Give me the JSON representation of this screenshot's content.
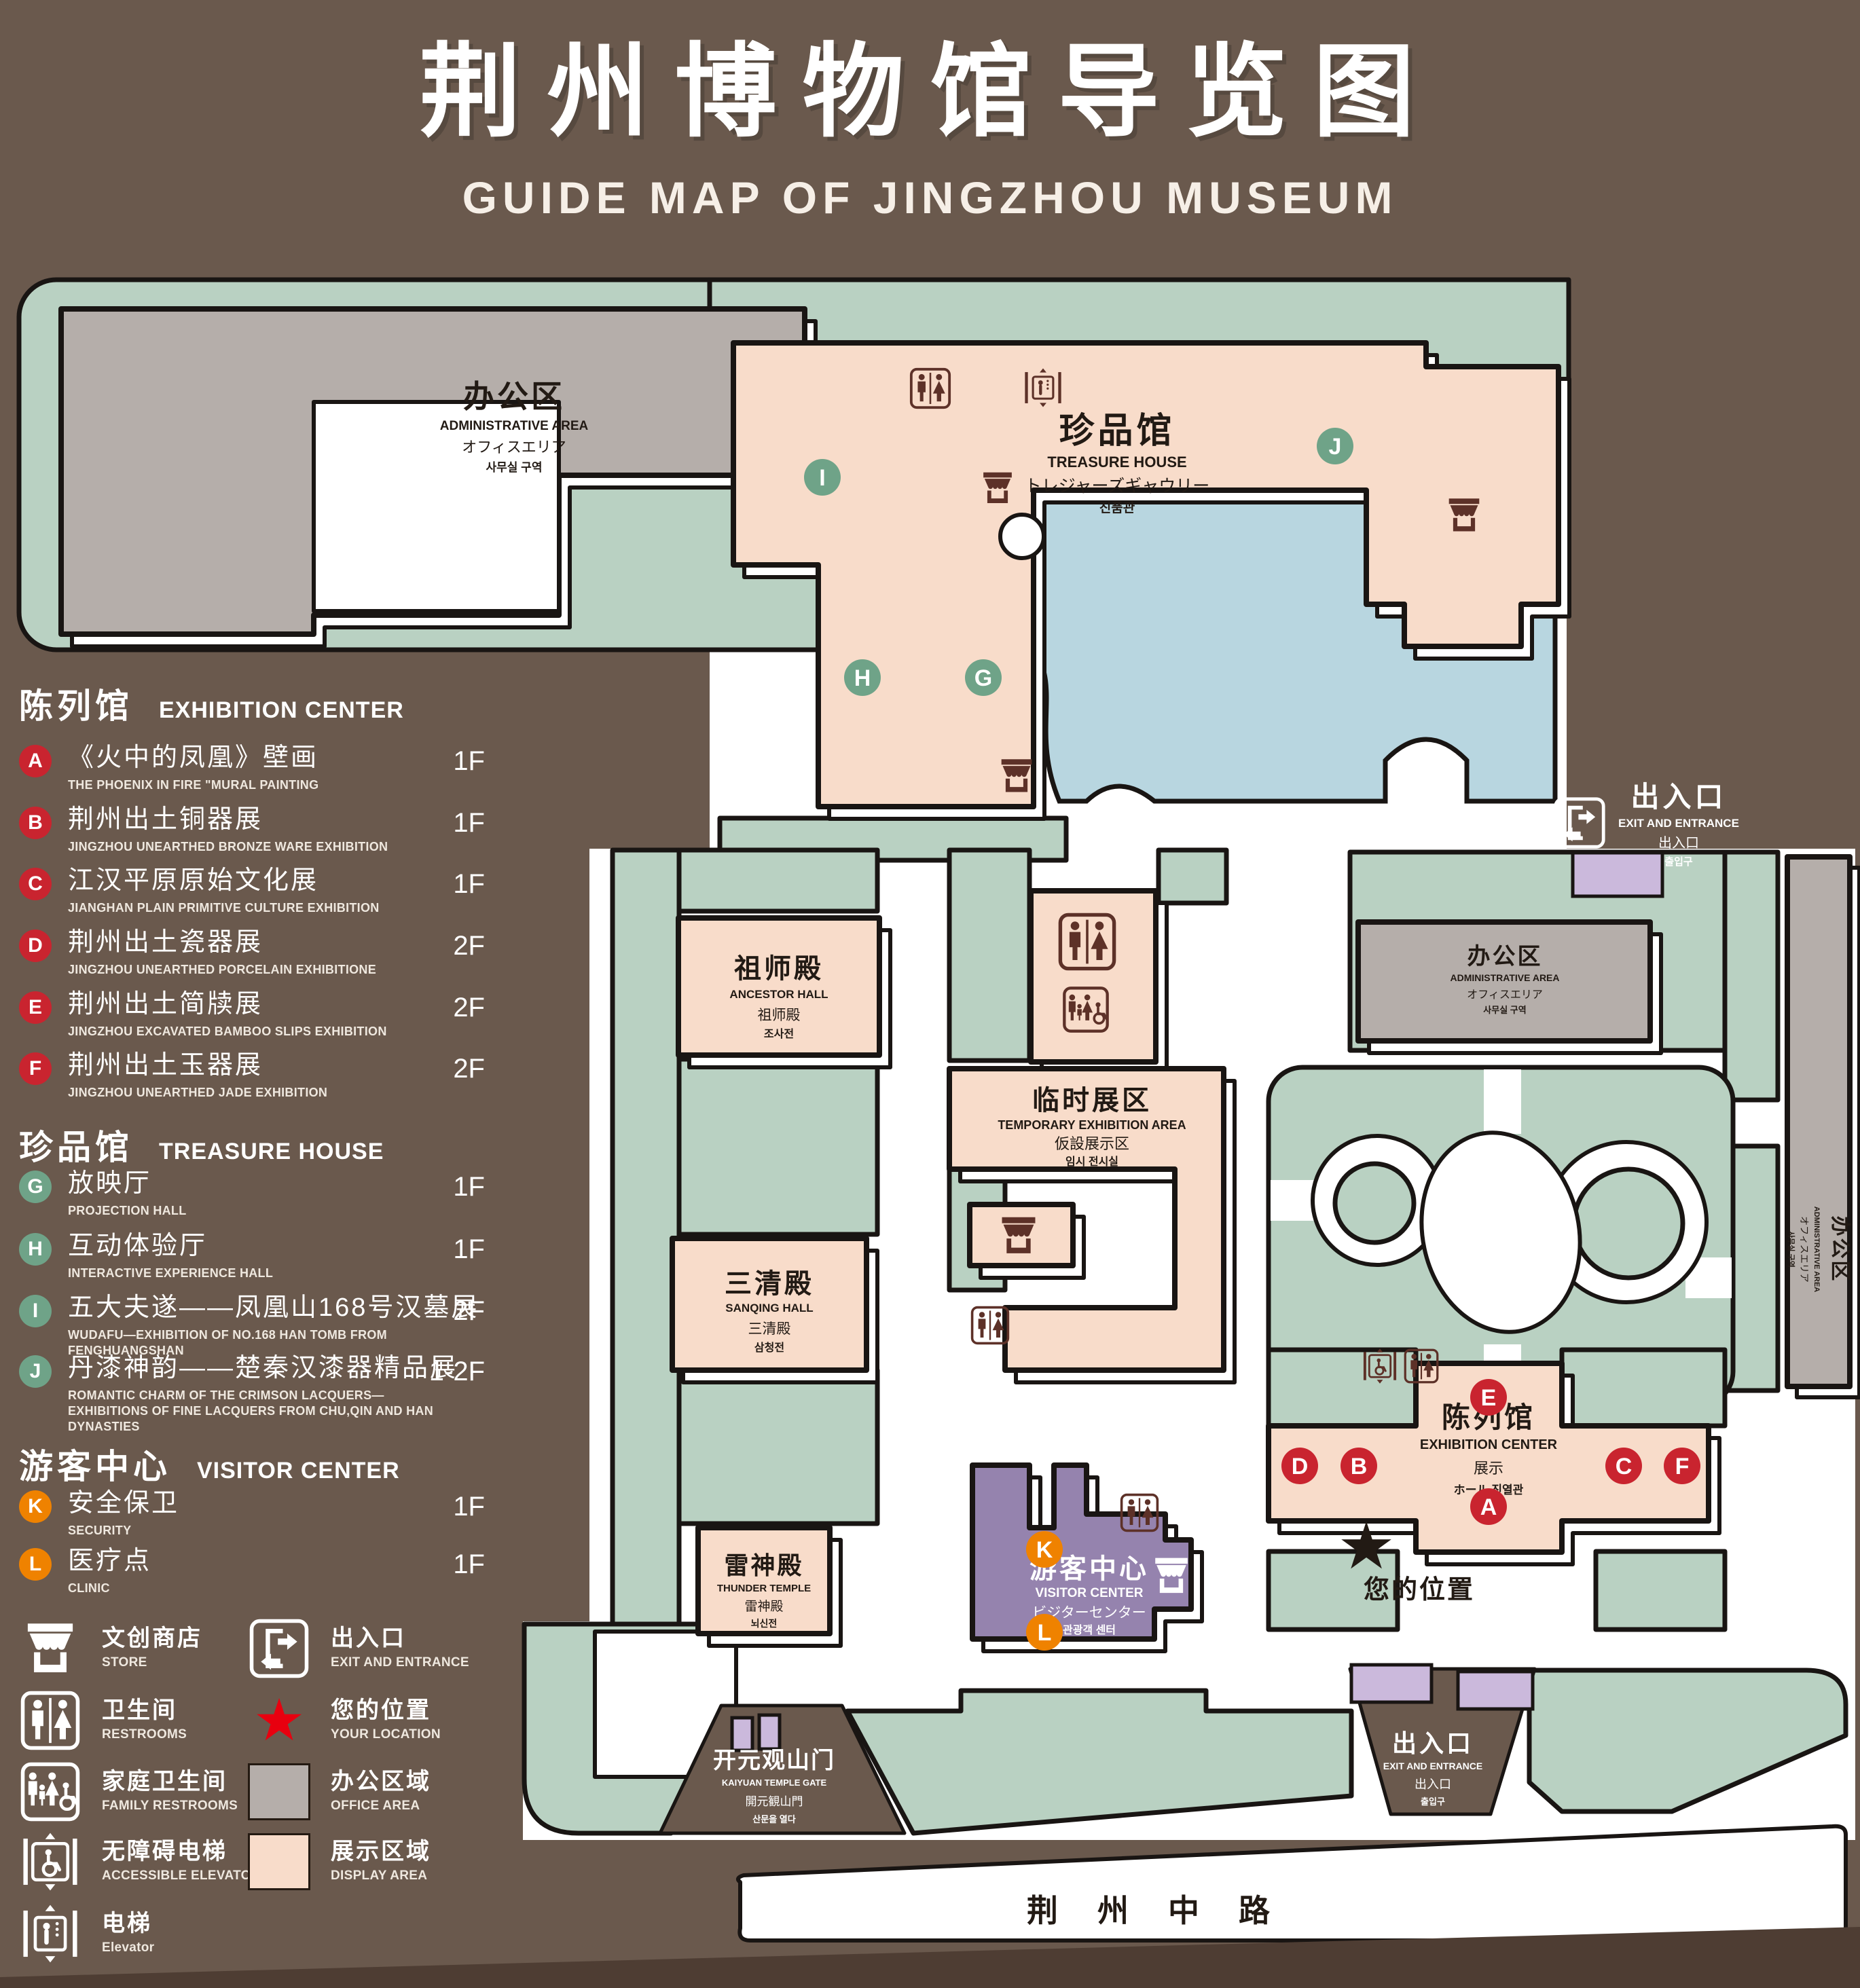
{
  "title": {
    "zh": "荆州博物馆导览图",
    "en": "GUIDE MAP OF JINGZHOU MUSEUM"
  },
  "legend": {
    "sections": [
      {
        "zh": "陈列馆",
        "en": "EXHIBITION CENTER",
        "items": [
          {
            "letter": "A",
            "zh": "《火中的凤凰》壁画",
            "en": "THE PHOENIX IN FIRE \"MURAL PAINTING",
            "floor": "1F"
          },
          {
            "letter": "B",
            "zh": "荆州出土铜器展",
            "en": "JINGZHOU UNEARTHED BRONZE WARE EXHIBITION",
            "floor": "1F"
          },
          {
            "letter": "C",
            "zh": "江汉平原原始文化展",
            "en": "JIANGHAN PLAIN PRIMITIVE CULTURE EXHIBITION",
            "floor": "1F"
          },
          {
            "letter": "D",
            "zh": "荆州出土瓷器展",
            "en": "JINGZHOU UNEARTHED PORCELAIN EXHIBITIONE",
            "floor": "2F"
          },
          {
            "letter": "E",
            "zh": "荆州出土简牍展",
            "en": "JINGZHOU EXCAVATED BAMBOO SLIPS EXHIBITION",
            "floor": "2F"
          },
          {
            "letter": "F",
            "zh": "荆州出土玉器展",
            "en": "JINGZHOU UNEARTHED JADE EXHIBITION",
            "floor": "2F"
          }
        ]
      },
      {
        "zh": "珍品馆",
        "en": "TREASURE HOUSE",
        "items": [
          {
            "letter": "G",
            "zh": "放映厅",
            "en": "PROJECTION HALL",
            "floor": "1F"
          },
          {
            "letter": "H",
            "zh": "互动体验厅",
            "en": "INTERACTIVE EXPERIENCE HALL",
            "floor": "1F"
          },
          {
            "letter": "I",
            "zh": "五大夫遂——凤凰山168号汉墓展",
            "en": "WUDAFU—EXHIBITION OF NO.168 HAN TOMB FROM FENGHUANGSHAN",
            "floor": "2F"
          },
          {
            "letter": "J",
            "zh": "丹漆神韵——楚秦汉漆器精品展",
            "en": "ROMANTIC CHARM OF THE CRIMSON LACQUERS—EXHIBITIONS OF FINE LACQUERS FROM CHU,QIN AND HAN DYNASTIES",
            "floor": "1-2F"
          }
        ]
      },
      {
        "zh": "游客中心",
        "en": "VISITOR CENTER",
        "items": [
          {
            "letter": "K",
            "zh": "安全保卫",
            "en": "SECURITY",
            "floor": "1F"
          },
          {
            "letter": "L",
            "zh": "医疗点",
            "en": "CLINIC",
            "floor": "1F"
          }
        ]
      }
    ],
    "symbols_left": [
      {
        "icon": "store-icon",
        "zh": "文创商店",
        "en": "STORE"
      },
      {
        "icon": "restroom-icon",
        "zh": "卫生间",
        "en": "RESTROOMS"
      },
      {
        "icon": "family-restroom-icon",
        "zh": "家庭卫生间",
        "en": "FAMILY RESTROOMS"
      },
      {
        "icon": "accessible-elevator-icon",
        "zh": "无障碍电梯",
        "en": "ACCESSIBLE ELEVATOR"
      },
      {
        "icon": "elevator-icon",
        "zh": "电梯",
        "en": "Elevator"
      }
    ],
    "symbols_right": [
      {
        "icon": "exit-icon",
        "zh": "出入口",
        "en": "EXIT AND ENTRANCE"
      },
      {
        "icon": "location-star-icon",
        "zh": "您的位置",
        "en": "YOUR LOCATION"
      },
      {
        "icon": "office-area-swatch",
        "zh": "办公区域",
        "en": "OFFICE AREA"
      },
      {
        "icon": "display-area-swatch",
        "zh": "展示区域",
        "en": "DISPLAY AREA"
      }
    ]
  },
  "map": {
    "admin_top": {
      "l1": "办公区",
      "l2": "ADMINISTRATIVE AREA",
      "l3": "オフィスエリア",
      "l4": "사무실 구역"
    },
    "admin_right": {
      "l1": "办公区",
      "l2": "ADMINISTRATIVE AREA",
      "l3": "オフィスエリア",
      "l4": "사무실 구역"
    },
    "admin_side": {
      "l1": "办公区",
      "l2": "ADMINISTRATIVE AREA",
      "l3": "オフィスエリア",
      "l4": "사무실 구역"
    },
    "treasure": {
      "l1": "珍品馆",
      "l2": "TREASURE HOUSE",
      "l3": "トレジャーズギャウリー",
      "l4": "진품관"
    },
    "ancestor": {
      "l1": "祖师殿",
      "l2": "ANCESTOR HALL",
      "l3": "祖师殿",
      "l4": "조사전"
    },
    "temporary": {
      "l1": "临时展区",
      "l2": "TEMPORARY EXHIBITION AREA",
      "l3": "仮設展示区",
      "l4": "임시 전시실"
    },
    "sanqing": {
      "l1": "三清殿",
      "l2": "SANQING HALL",
      "l3": "三清殿",
      "l4": "삼청전"
    },
    "thunder": {
      "l1": "雷神殿",
      "l2": "THUNDER TEMPLE",
      "l3": "雷神殿",
      "l4": "뇌신전"
    },
    "visitor": {
      "l1": "游客中心",
      "l2": "VISITOR CENTER",
      "l3": "ビジターセンター",
      "l4": "관광객 센터"
    },
    "exhibition": {
      "l1": "陈列馆",
      "l2": "EXHIBITION CENTER",
      "l3": "展示",
      "l4": "ホール 진열관"
    },
    "exit_top": {
      "l1": "出入口",
      "l2": "EXIT AND ENTRANCE",
      "l3": "出入口",
      "l4": "출입구"
    },
    "exit_bottom": {
      "l1": "出入口",
      "l2": "EXIT AND ENTRANCE",
      "l3": "出入口",
      "l4": "출입구"
    },
    "gate": {
      "l1": "开元观山门",
      "l2": "KAIYUAN TEMPLE GATE",
      "l3": "開元観山門",
      "l4": "산문을 열다"
    },
    "road": "荆州中路",
    "your_location": "您的位置",
    "star": "★",
    "markers": {
      "a": "A",
      "b": "B",
      "c": "C",
      "d": "D",
      "e": "E",
      "f": "F",
      "g": "G",
      "h": "H",
      "i": "I",
      "j": "J",
      "k": "K",
      "l": "L"
    }
  },
  "colors": {
    "background": "#6a594d",
    "green_area": "#b9d1c2",
    "display_area": "#f8dcca",
    "office_area": "#b5aeaa",
    "visitor_purple": "#9583ae",
    "entrance_purple": "#cbb9dc",
    "lake_blue": "#b8d6e0",
    "marker_red": "#c9242f",
    "marker_green": "#6fa388",
    "marker_orange": "#ef8200",
    "location_red": "#e8000f",
    "icon_brown": "#5d3128",
    "outline": "#191513"
  }
}
